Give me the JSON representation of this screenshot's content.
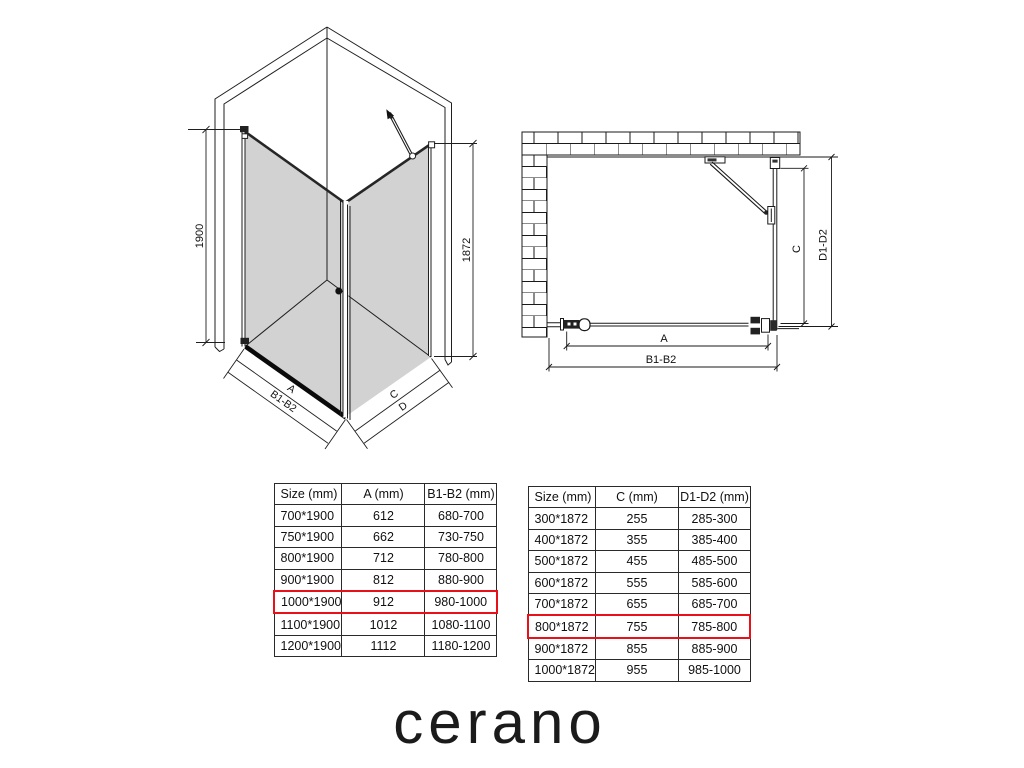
{
  "brand": {
    "logo_text": "cerano"
  },
  "colors": {
    "highlight": "#e8111a",
    "glass": "#d2d2d2",
    "line": "#1f1f1f"
  },
  "diagram_left": {
    "labels": {
      "height_left": "1900",
      "height_right": "1872",
      "door_width": "A",
      "door_adjust": "B1-B2",
      "side_width": "C",
      "side_adjust": "D"
    }
  },
  "diagram_right": {
    "labels": {
      "door_width": "A",
      "door_adjust": "B1-B2",
      "side_length": "C",
      "side_adjust": "D1-D2"
    }
  },
  "tables": {
    "left": {
      "headers": [
        "Size (mm)",
        "A (mm)",
        "B1-B2 (mm)"
      ],
      "rows": [
        [
          "700*1900",
          "612",
          "680-700"
        ],
        [
          "750*1900",
          "662",
          "730-750"
        ],
        [
          "800*1900",
          "712",
          "780-800"
        ],
        [
          "900*1900",
          "812",
          "880-900"
        ],
        [
          "1000*1900",
          "912",
          "980-1000"
        ],
        [
          "1100*1900",
          "1012",
          "1080-1100"
        ],
        [
          "1200*1900",
          "1112",
          "1180-1200"
        ]
      ],
      "highlighted_row_index": 4
    },
    "right": {
      "headers": [
        "Size (mm)",
        "C (mm)",
        "D1-D2 (mm)"
      ],
      "rows": [
        [
          "300*1872",
          "255",
          "285-300"
        ],
        [
          "400*1872",
          "355",
          "385-400"
        ],
        [
          "500*1872",
          "455",
          "485-500"
        ],
        [
          "600*1872",
          "555",
          "585-600"
        ],
        [
          "700*1872",
          "655",
          "685-700"
        ],
        [
          "800*1872",
          "755",
          "785-800"
        ],
        [
          "900*1872",
          "855",
          "885-900"
        ],
        [
          "1000*1872",
          "955",
          "985-1000"
        ]
      ],
      "highlighted_row_index": 5
    }
  }
}
